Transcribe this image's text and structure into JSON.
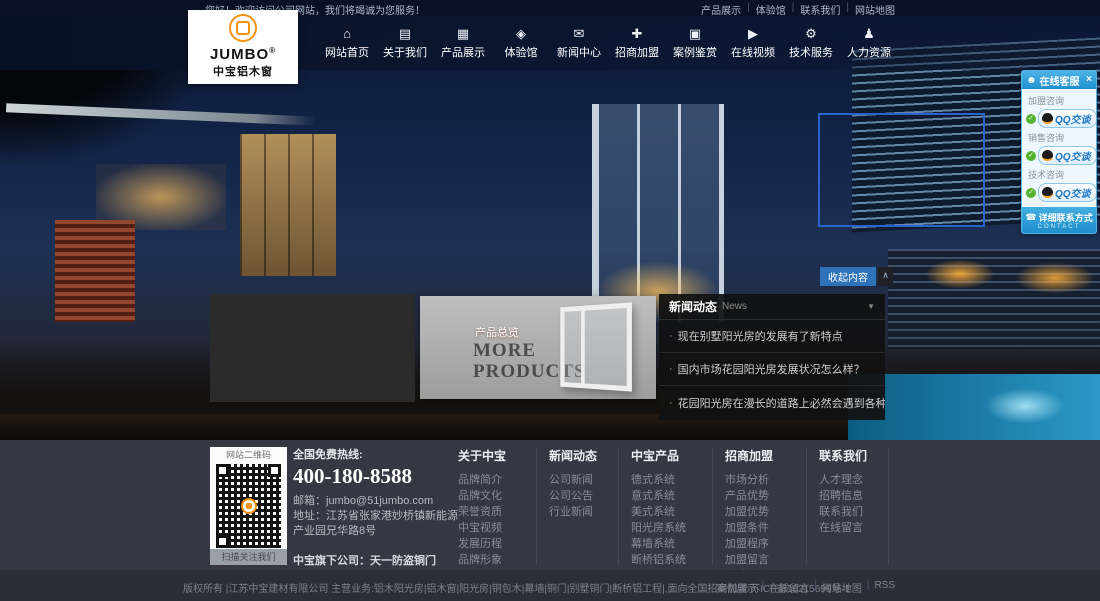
{
  "topbar": {
    "welcome": "您好！欢迎访问公司网站，我们将竭诚为您服务！",
    "separator": "|",
    "links": [
      {
        "label": "产品展示"
      },
      {
        "label": "体验馆"
      },
      {
        "label": "联系我们"
      },
      {
        "label": "网站地图"
      }
    ]
  },
  "logo": {
    "brand": "JUMBO",
    "reg": "®",
    "subtitle": "中宝铝木窗"
  },
  "nav": {
    "items": [
      {
        "label": "网站首页",
        "glyph": "⌂"
      },
      {
        "label": "关于我们",
        "glyph": "▤"
      },
      {
        "label": "产品展示",
        "glyph": "▦"
      },
      {
        "label": "体验馆",
        "glyph": "◈"
      },
      {
        "label": "新闻中心",
        "glyph": "✉"
      },
      {
        "label": "招商加盟",
        "glyph": "✚"
      },
      {
        "label": "案例鉴赏",
        "glyph": "▣"
      },
      {
        "label": "在线视频",
        "glyph": "▶"
      },
      {
        "label": "技术服务",
        "glyph": "⚙"
      },
      {
        "label": "人力资源",
        "glyph": "♟"
      }
    ]
  },
  "qq_panel": {
    "title": "在线客服",
    "user_glyph": "☻",
    "close": "×",
    "status_icon": "✓",
    "groups": [
      {
        "label": "加盟咨询",
        "button": "QQ交谈"
      },
      {
        "label": "销售咨询",
        "button": "QQ交谈"
      },
      {
        "label": "技术咨询",
        "button": "QQ交谈"
      }
    ],
    "footer": {
      "chat_glyph": "☎",
      "label": "详细联系方式",
      "sub": "CONTACT"
    }
  },
  "hero": {
    "collapse_button": "收起内容",
    "collapse_icon": "∧"
  },
  "products": {
    "tag": "产品总览",
    "title_line1": "MORE",
    "title_line2": "PRODUCTS"
  },
  "news": {
    "title": "新闻动态",
    "subtitle": "News",
    "dropdown_icon": "▼",
    "bullet": "·",
    "items": [
      "现在别墅阳光房的发展有了新特点",
      "国内市场花园阳光房发展状况怎么样？",
      "花园阳光房在漫长的道路上必然会遇到各种挑战"
    ]
  },
  "footer": {
    "qr": {
      "top": "网站二维码",
      "bottom": "扫描关注我们"
    },
    "hotline_label": "全国免费热线:",
    "hotline": "400-180-8588",
    "email": "邮箱：jumbo@51jumbo.com",
    "address": "地址：江苏省张家港妙桥镇新能源产业园兄华路8号",
    "subsidiary": "中宝旗下公司：天一防盗铜门",
    "columns": [
      {
        "title": "关于中宝",
        "links": [
          "品牌简介",
          "品牌文化",
          "荣誉资质",
          "中宝视频",
          "发展历程",
          "品牌形象"
        ]
      },
      {
        "title": "新闻动态",
        "links": [
          "公司新闻",
          "公司公告",
          "行业新闻"
        ]
      },
      {
        "title": "中宝产品",
        "links": [
          "德式系统",
          "意式系统",
          "美式系统",
          "阳光房系统",
          "幕墙系统",
          "断桥铝系统"
        ]
      },
      {
        "title": "招商加盟",
        "links": [
          "市场分析",
          "产品优势",
          "加盟优势",
          "加盟条件",
          "加盟程序",
          "加盟留言",
          "申请表下载"
        ]
      },
      {
        "title": "联系我们",
        "links": [
          "人才理念",
          "招聘信息",
          "联系我们",
          "在线留言"
        ]
      }
    ]
  },
  "bottombar": {
    "copyright": "版权所有 |江苏中宝建材有限公司 主营业务:铝木阳光房|铝木窗|阳光房|铜包木|幕墙|铜门|别墅铜门|断桥铝工程|,面向全国招商加盟 苏ICP备10215699号-1",
    "separator": "|",
    "links": [
      "案例展示",
      "在线留言",
      "网站地图",
      "RSS"
    ]
  },
  "colors": {
    "accent_orange": "#f29214",
    "qq_blue": "#2f9fd8",
    "collapse_blue": "#2e72b8",
    "footer_bg": "#353842"
  }
}
